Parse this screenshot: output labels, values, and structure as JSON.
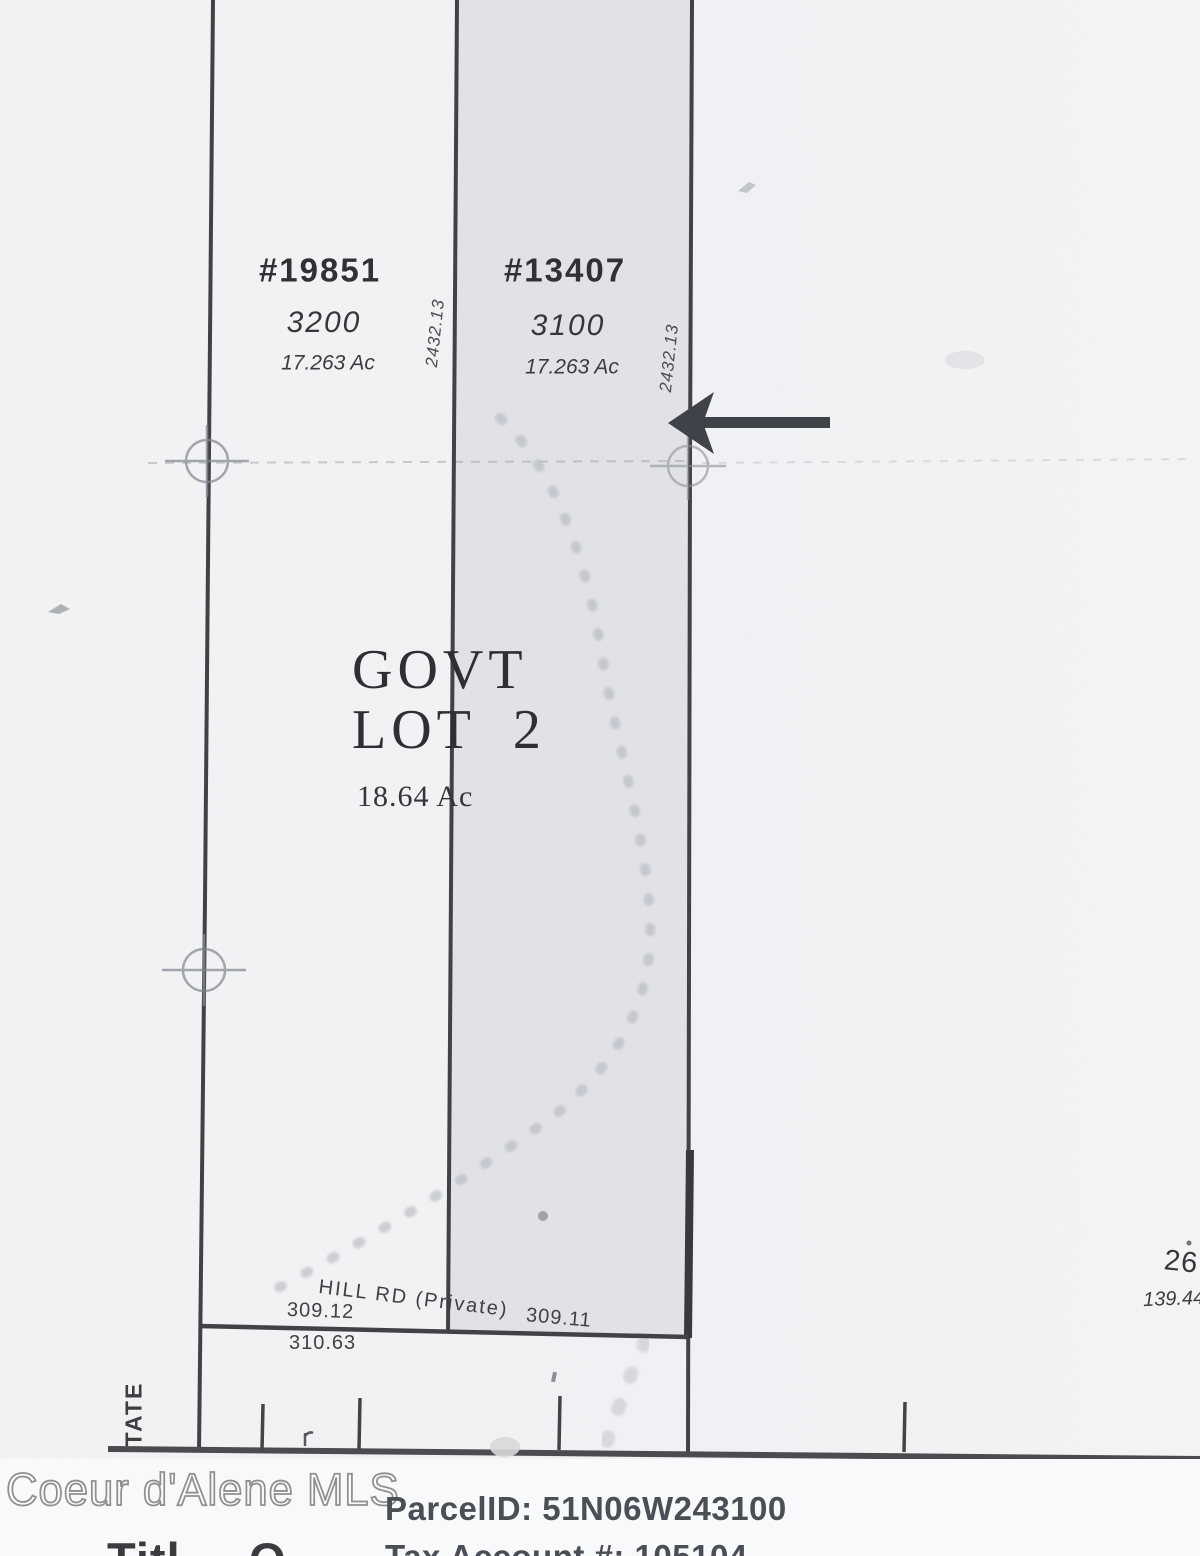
{
  "map": {
    "parcels": [
      {
        "id": "#19851",
        "lot": "3200",
        "acreage": "17.263 Ac"
      },
      {
        "id": "#13407",
        "lot": "3100",
        "acreage": "17.263 Ac"
      }
    ],
    "boundary_bearings": {
      "left": "2432.13",
      "right": "2432.13"
    },
    "govt_lot": {
      "line1": "GOVT",
      "line2": "LOT  2",
      "acreage": "18.64 Ac"
    },
    "road": {
      "name": "HILL RD (Private)",
      "frontage_left": "309.12",
      "frontage_right": "309.11",
      "south_dim": "310.63"
    },
    "left_edge_label": "TATE",
    "right_edge": {
      "section": "26",
      "distance": "139.44"
    }
  },
  "footer": {
    "watermark": "Coeur d'Alene MLS",
    "parcel_id": "ParcelID: 51N06W243100",
    "tax_account": "Tax Account #: 105104",
    "logo_fragment_left": "Titl",
    "logo_fragment_right": "O"
  },
  "colors": {
    "ink": "#3d3f44",
    "highlight_band": "#e1e3e7",
    "paper": "#f2f3f5",
    "footer_text": "#4a4e56"
  }
}
